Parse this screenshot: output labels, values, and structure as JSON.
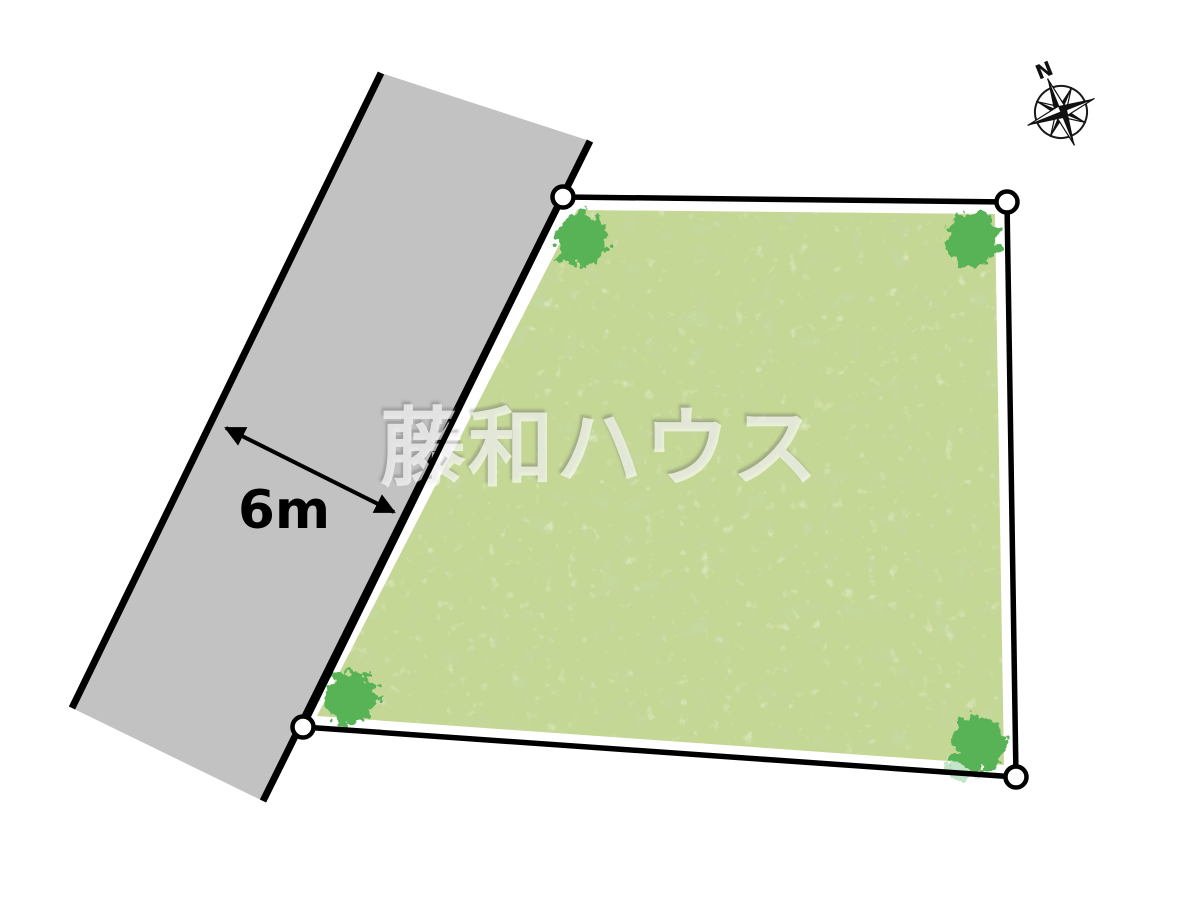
{
  "diagram": {
    "watermark_text": "藤和ハウス",
    "road": {
      "width_label": "6m"
    },
    "compass": {
      "north_label": "N"
    },
    "colors": {
      "road_fill": "#c2c2c2",
      "plot_fill": "#c5d795",
      "tree_fill": "#58b356",
      "tree_light_fill": "#93d19c",
      "outline": "#000000",
      "marker_fill": "#ffffff"
    }
  }
}
